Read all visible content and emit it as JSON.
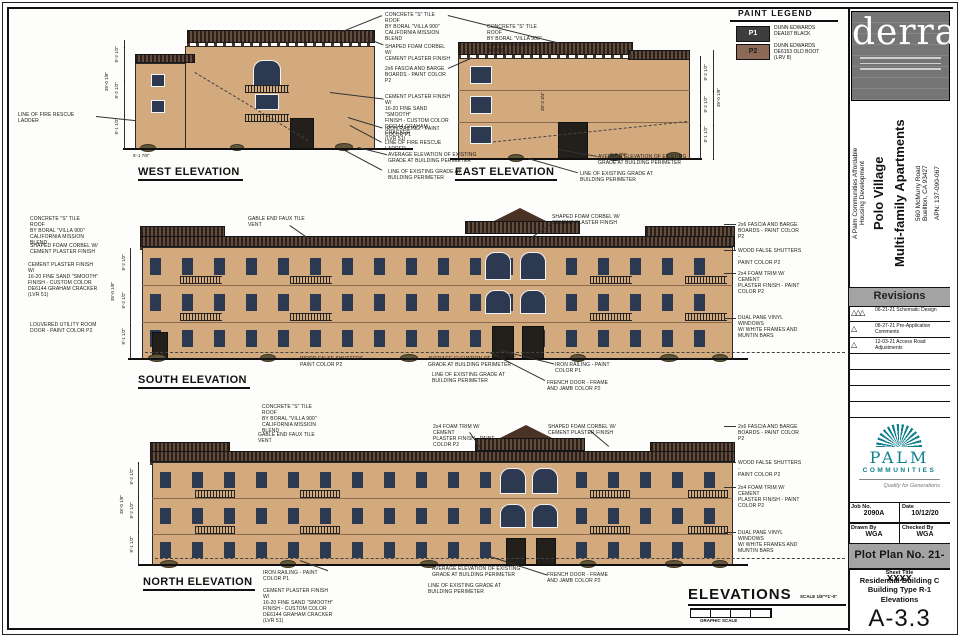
{
  "paint_legend": {
    "title": "PAINT LEGEND",
    "p1_code": "P1",
    "p1_desc": "DUNN EDWARDS\nDEA187 BLACK",
    "p1_color": "#3d3d3d",
    "p2_code": "P2",
    "p2_desc": "DUNN EDWARDS\nDE6153 OLD BOOT\n(LRV 8)",
    "p2_color": "#8d6a57"
  },
  "notes": {
    "tile_roof": "CONCRETE \"S\" TILE ROOF\nBY BORAL \"VILLA 900\"\nCALIFORNIA MISSION\nBLEND",
    "corbel": "SHAPED FOAM CORBEL W/\nCEMENT PLASTER FINISH",
    "fascia": "2x6 FASCIA AND BARGE\nBOARDS - PAINT COLOR\nP2",
    "plaster": "CEMENT PLASTER FINISH W/\n16-20 FINE SAND \"SMOOTH\"\nFINISH - CUSTOM COLOR\nDE6144 GRAHAM CRACKER\n(LVR 51)",
    "iron_railing": "IRON RAILING - PAINT\nCOLOR P1",
    "fire_ladder": "LINE OF FIRE RESCUE\nLADDER",
    "avg_grade": "AVERAGE ELEVATION OF EXISTING\nGRADE AT BUILDING PERIMETER",
    "grade_line": "LINE OF EXISTING GRADE AT\nBUILDING PERIMETER",
    "gable_vent": "GABLE END FAUX TILE\nVENT",
    "shutters": "WOOD FALSE SHUTTERS -\nPAINT COLOR P2",
    "foam_trim": "2x4 FOAM TRIM W/ CEMENT\nPLASTER FINISH - PAINT\nCOLOR P2",
    "vinyl_windows": "DUAL PANE VINYL WINDOWS\nW/ WHITE FRAMES AND\nMUNTIN BARS",
    "utility_door": "LOUVERED UTILITY ROOM\nDOOR - PAINT COLOR P2",
    "french_door": "FRENCH DOOR - FRAME\nAND JAMB COLOR P2"
  },
  "labels": {
    "west": "WEST ELEVATION",
    "east": "EAST ELEVATION",
    "south": "SOUTH ELEVATION",
    "north": "NORTH ELEVATION",
    "elevations_title": "ELEVATIONS",
    "scale": "SCALE 1/8\"=1'-0\"",
    "graphic_scale": "GRAPHIC SCALE"
  },
  "dims": {
    "total_height": "35'-0 1/8\"",
    "floor3": "8'-2 1/2\"",
    "floor2": "8'-2 1/2\"",
    "floor1": "8'-1 1/2\"",
    "roof_slope": "20'-3 3/4\"",
    "grade_offset_w": "6'-1 7/8\"",
    "grade_offset_e": "6'-0 7/8\""
  },
  "sidebar": {
    "firm_name": "derra",
    "project": {
      "dev_line": "A Palm Communities Affordable\nHousing Development",
      "name": "Polo Village\nMulti-family Apartments",
      "address": "560 McMurry Road\nBuellton, CA 93427",
      "apn": "APN: 137-090-067"
    },
    "revisions": {
      "title": "Revisions",
      "rows": [
        {
          "text": "06-21-21  Schematic Design"
        },
        {
          "text": "08-27-21  Pre-Application\nComments"
        },
        {
          "text": "12-03-21  Access Road\nAdjustments"
        }
      ]
    },
    "palm": {
      "name": "PALM",
      "sub": "COMMUNITIES",
      "tagline": "Quality for Generations",
      "color": "#0f7f8e"
    },
    "titleblock": {
      "job_label": "Job No.",
      "job_value": "2090A",
      "date_label": "Date",
      "date_value": "10/12/20",
      "drawn_label": "Drawn By",
      "drawn_value": "WGA",
      "checked_label": "Checked By",
      "checked_value": "WGA",
      "plot_plan": "Plot Plan No. 21-xxxx",
      "sheet_title_label": "Sheet Title",
      "sheet_title_lines": "Residential Building C\nBuilding Type R-1\nElevations",
      "sheet_number": "A-3.3"
    }
  }
}
